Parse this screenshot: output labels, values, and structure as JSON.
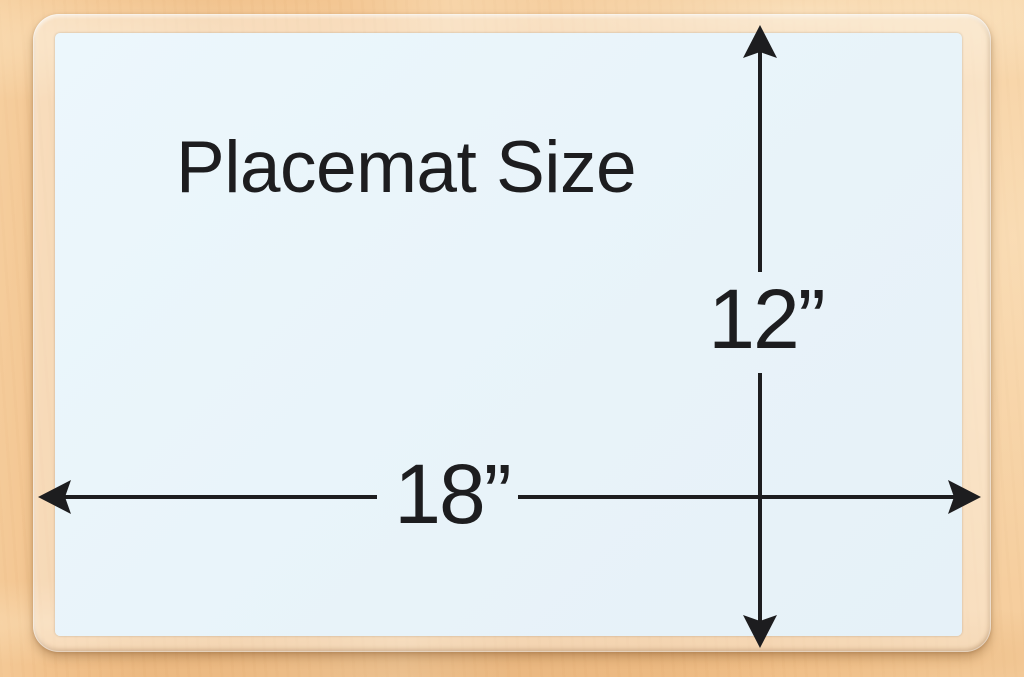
{
  "diagram": {
    "title": "Placemat Size",
    "width_label": "18”",
    "height_label": "12”",
    "colors": {
      "wood": "#f2c28c",
      "mat": "#e9f4fa",
      "line": "#1d1d1f"
    }
  }
}
